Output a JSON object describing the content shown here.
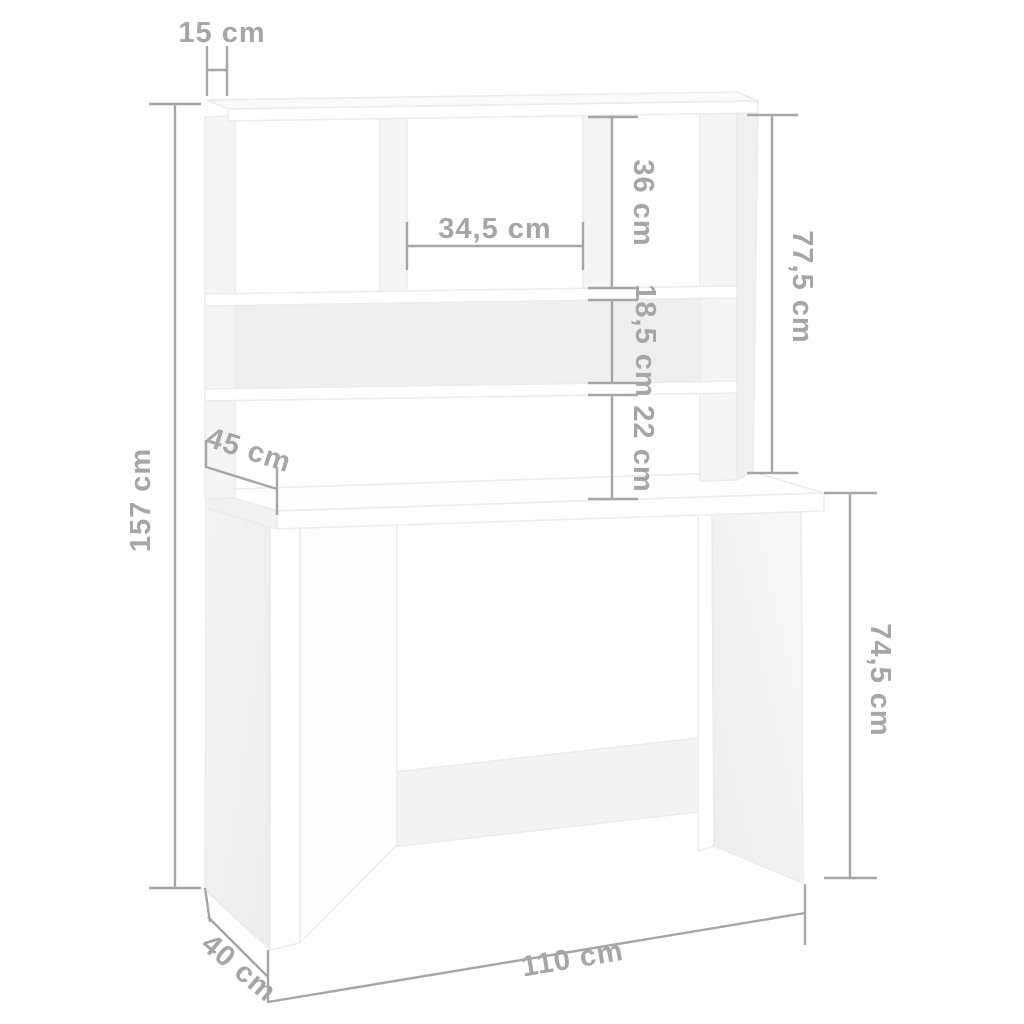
{
  "diagram": {
    "kind": "furniture-dimension-diagram",
    "subject": "desk-with-hutch-shelves",
    "unit": "cm",
    "colors": {
      "background": "#ffffff",
      "dimension_lines": "#a6a6a6",
      "dimension_text": "#a6a6a6",
      "furniture_fill": "#ffffff",
      "furniture_shade": "#f1f1f1",
      "furniture_outline": "#ebebeb"
    },
    "dimensions": {
      "hutch_top_depth": {
        "label": "15 cm",
        "value": 15,
        "orientation": "horizontal-top"
      },
      "total_height": {
        "label": "157 cm",
        "value": 157,
        "orientation": "vertical-left"
      },
      "middle_compartment_width": {
        "label": "34,5 cm",
        "value": 34.5,
        "orientation": "horizontal"
      },
      "upper_compartment_height": {
        "label": "36 cm",
        "value": 36,
        "orientation": "vertical"
      },
      "hutch_height": {
        "label": "77,5 cm",
        "value": 77.5,
        "orientation": "vertical-right"
      },
      "shelf_compartment_height": {
        "label": "18,5 cm",
        "value": 18.5,
        "orientation": "vertical"
      },
      "shelf_to_desktop_gap": {
        "label": "22 cm",
        "value": 22,
        "orientation": "vertical"
      },
      "desktop_depth": {
        "label": "45 cm",
        "value": 45,
        "orientation": "diagonal-depth"
      },
      "desk_height": {
        "label": "74,5 cm",
        "value": 74.5,
        "orientation": "vertical-right"
      },
      "base_depth": {
        "label": "40 cm",
        "value": 40,
        "orientation": "diagonal-depth"
      },
      "desk_width": {
        "label": "110 cm",
        "value": 110,
        "orientation": "horizontal-bottom"
      }
    }
  }
}
